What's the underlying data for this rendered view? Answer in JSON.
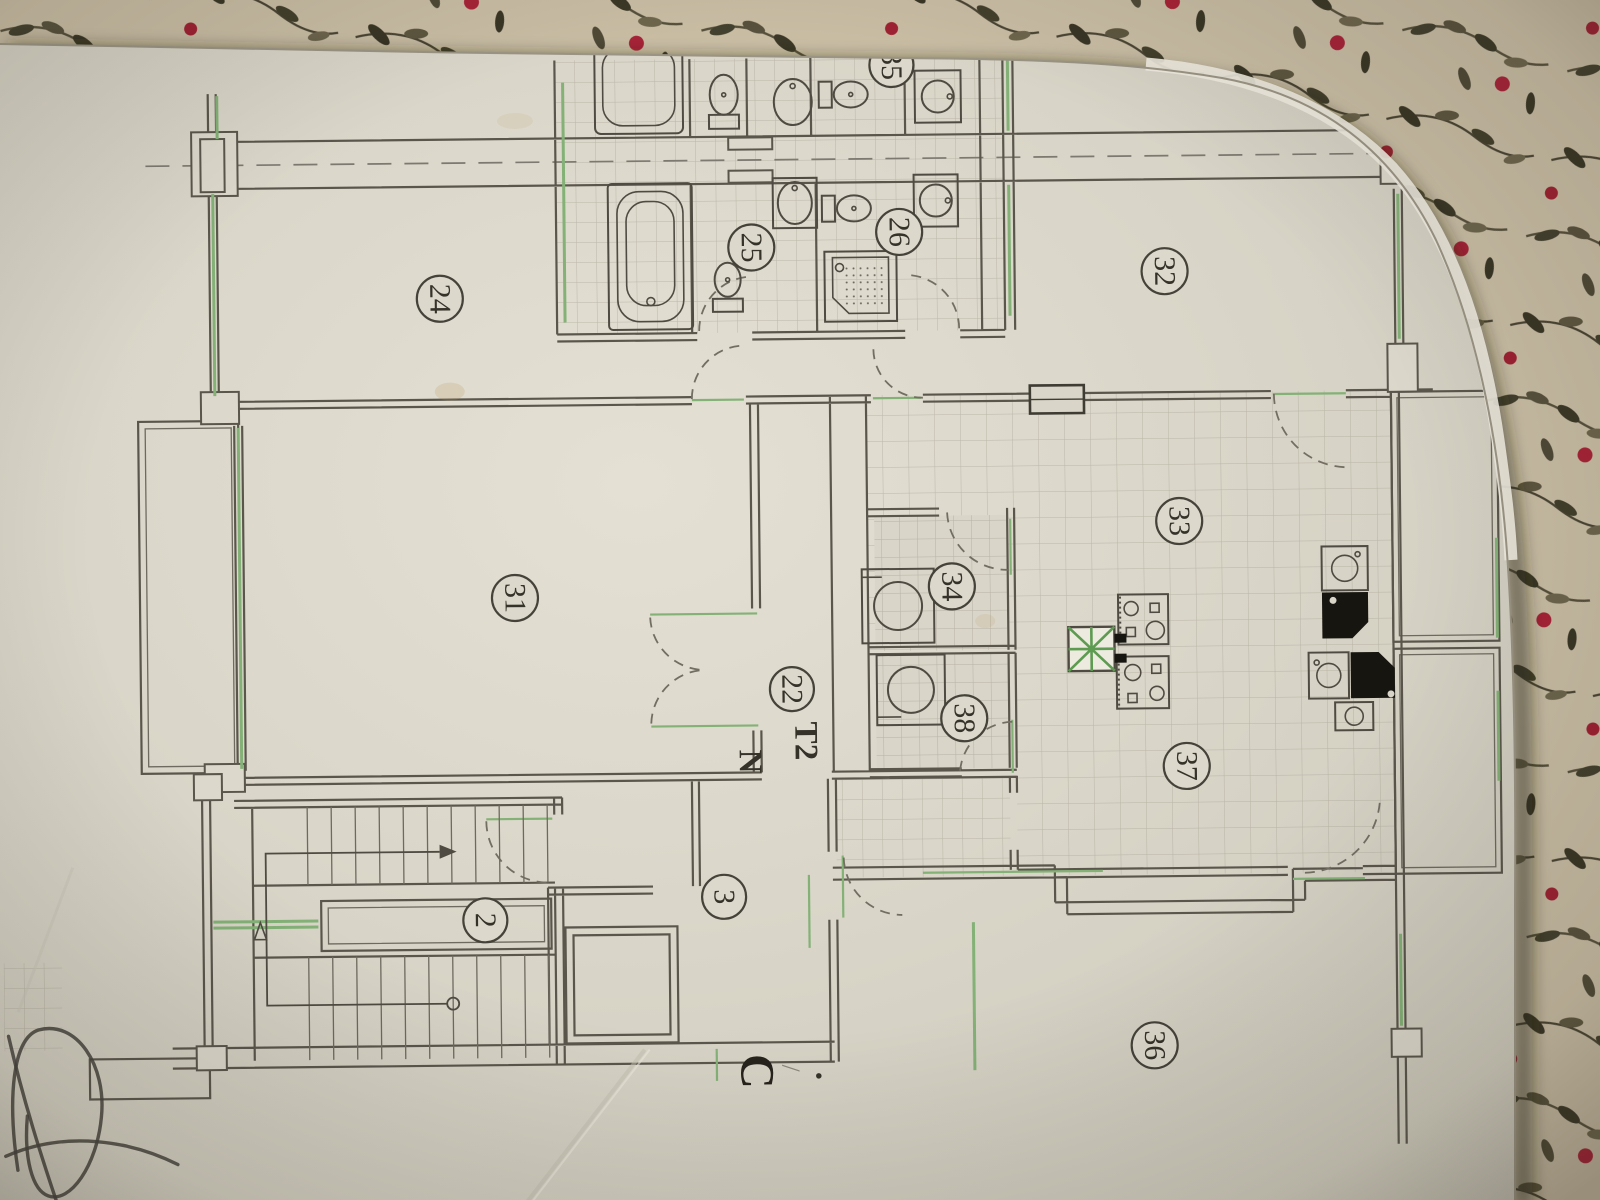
{
  "photo": {
    "subject": "paper architectural floor plan photographed on floral fabric",
    "unit_type": "T2"
  },
  "labels": {
    "r24": "24",
    "r25": "25",
    "r26": "26",
    "r35": "35",
    "r32": "32",
    "r31": "31",
    "r22": "22",
    "r33": "33",
    "r34": "34",
    "r38": "38",
    "r37": "37",
    "r36": "36",
    "r2": "2",
    "r3": "3"
  },
  "annotations": {
    "t2": "T2",
    "n": "N",
    "c": "C",
    "slash": "/",
    "dot": "."
  },
  "colors": {
    "paper": "#dad6c9",
    "ink": "#5b564c",
    "green_accent": "#83b176",
    "fixture_black": "#16150f",
    "fabric_base": "#c9bda4",
    "fabric_leaf": "#4a4433",
    "fabric_berry": "#a72337"
  }
}
